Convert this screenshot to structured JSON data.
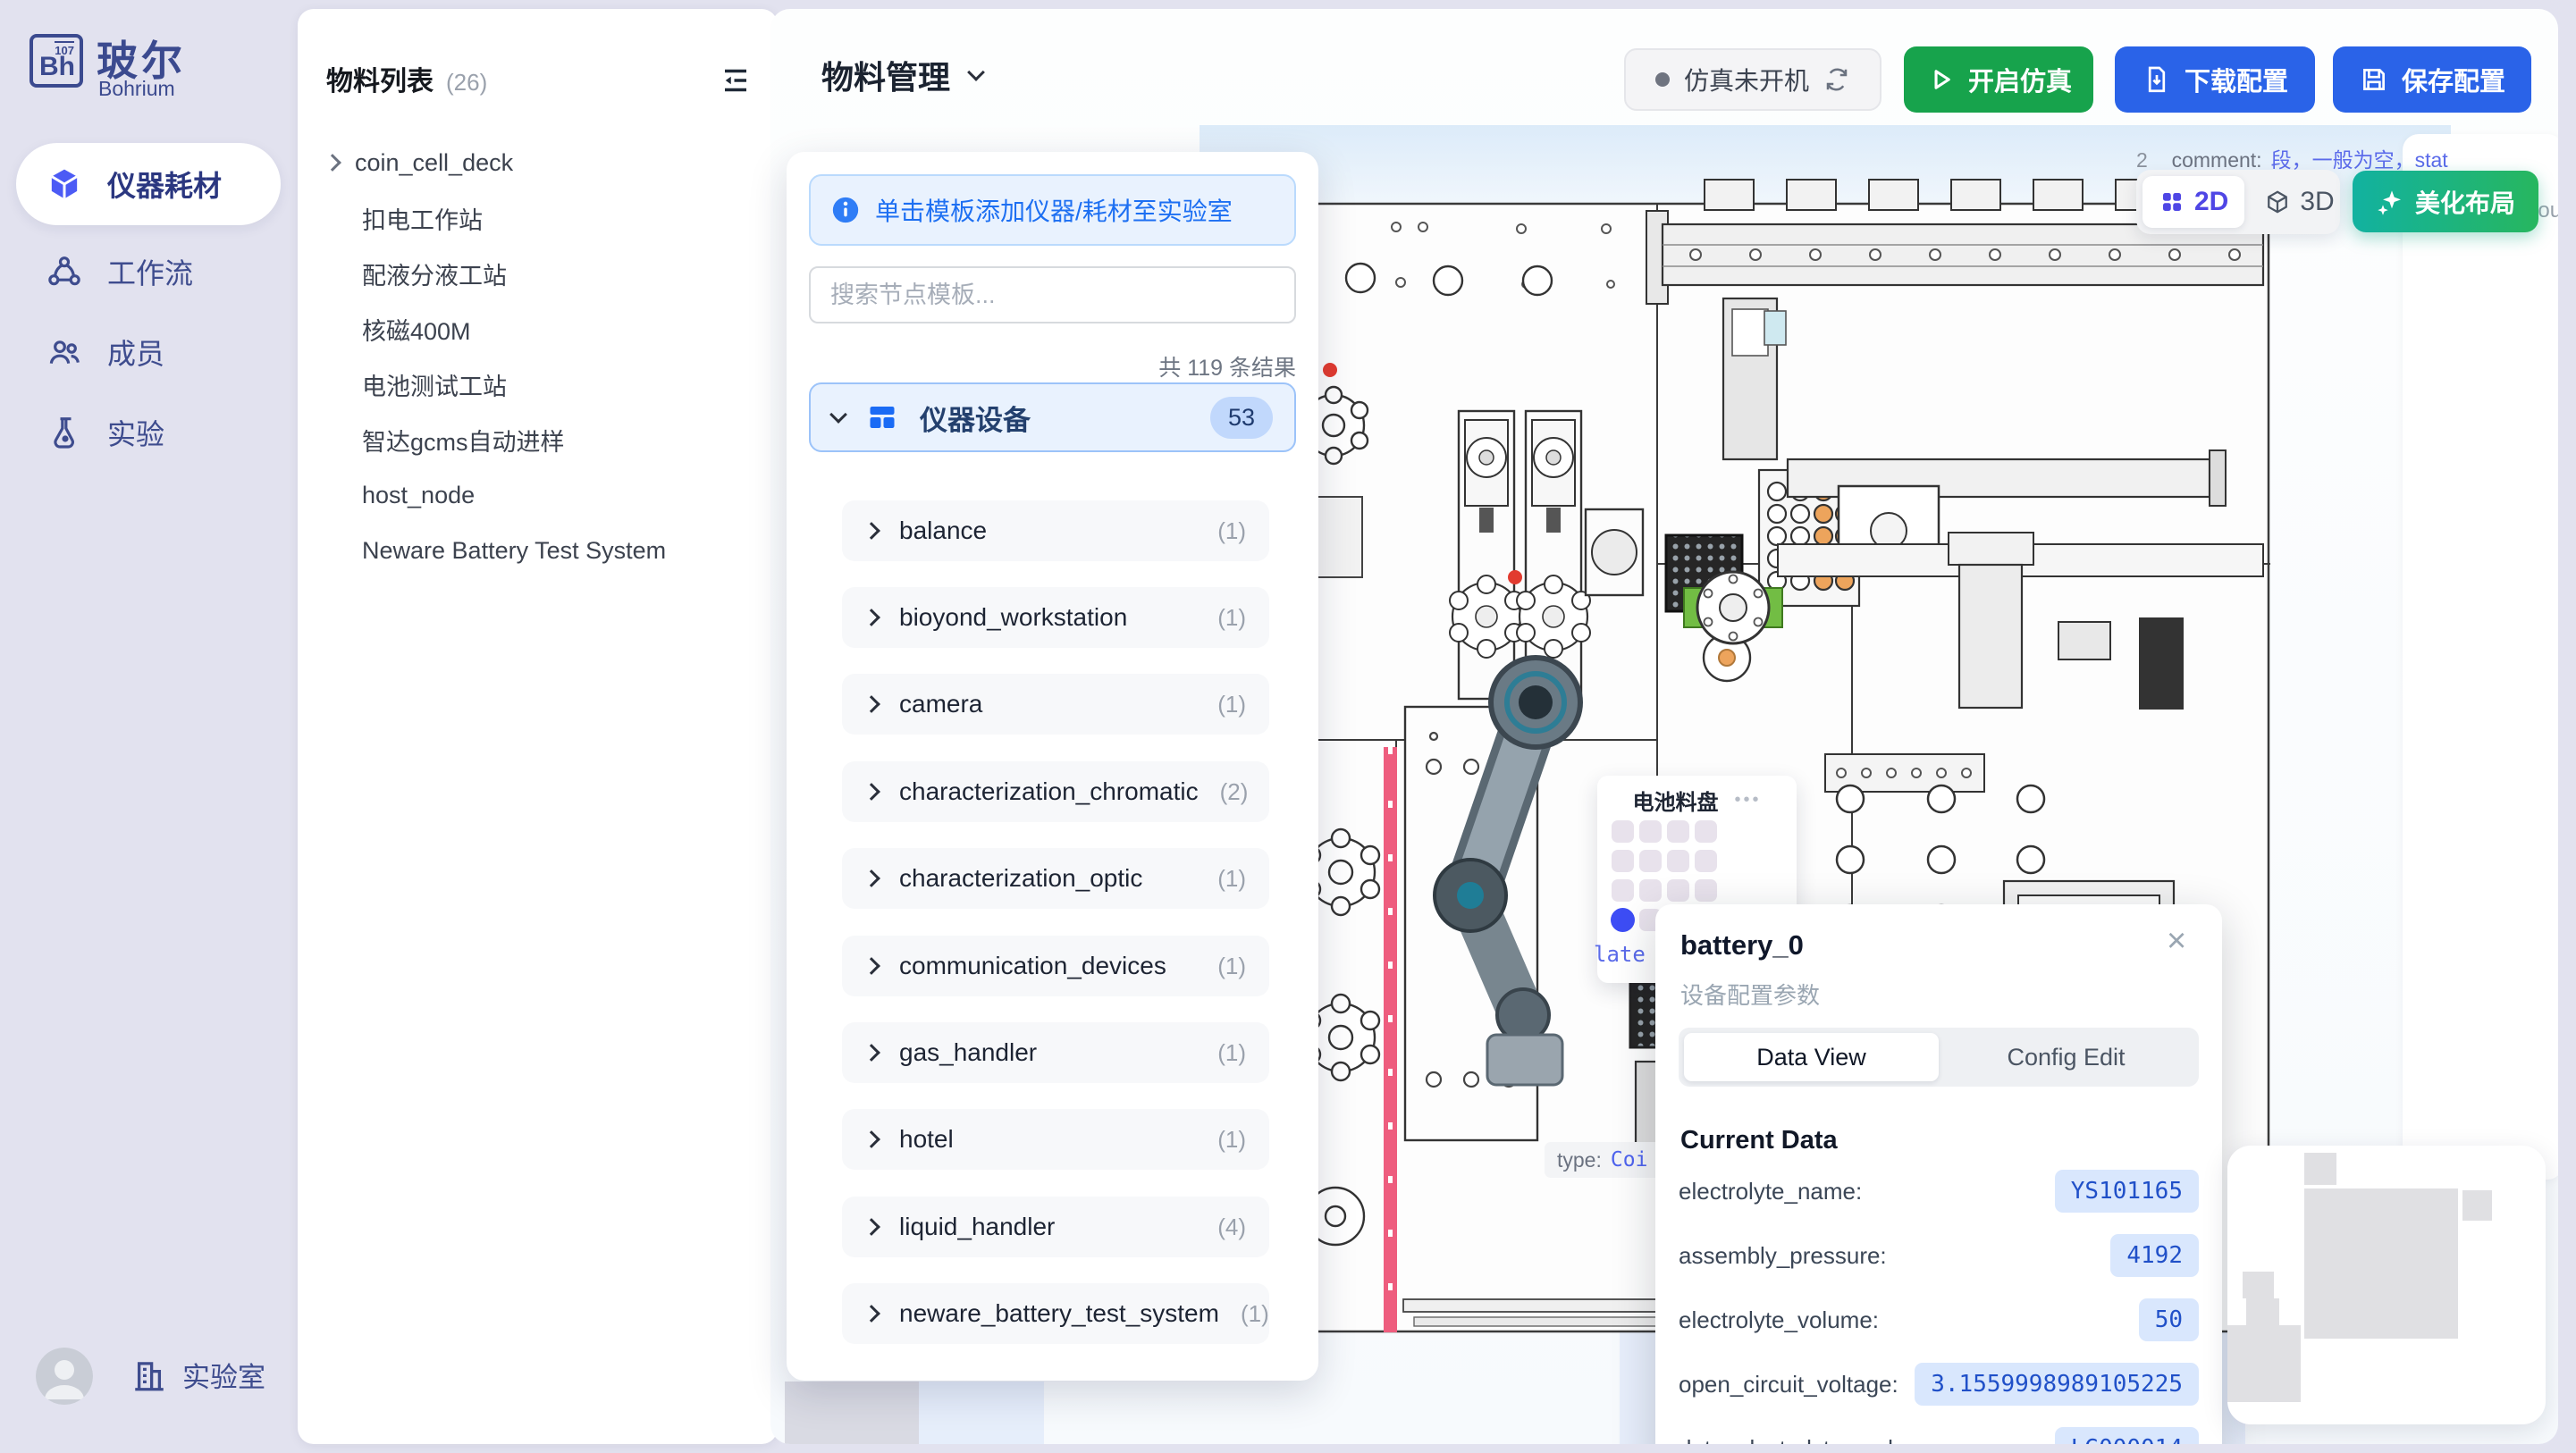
{
  "sidebar": {
    "logo": {
      "element": "Bh",
      "number": "107",
      "title": "玻尔",
      "subtitle": "Bohrium"
    },
    "items": [
      {
        "label": "仪器耗材",
        "icon": "cube-icon",
        "active": true
      },
      {
        "label": "工作流",
        "icon": "workflow-icon",
        "active": false
      },
      {
        "label": "成员",
        "icon": "members-icon",
        "active": false
      },
      {
        "label": "实验",
        "icon": "experiment-icon",
        "active": false
      }
    ],
    "footer": {
      "lab": "实验室"
    }
  },
  "materials": {
    "title": "物料列表",
    "count": "(26)",
    "items": [
      "coin_cell_deck",
      "扣电工作站",
      "配液分液工站",
      "核磁400M",
      "电池测试工站",
      "智达gcms自动进样",
      "host_node",
      "Neware Battery Test System"
    ]
  },
  "topbar": {
    "title": "物料管理",
    "status": "仿真未开机",
    "start": "开启仿真",
    "download": "下载配置",
    "save": "保存配置"
  },
  "templates": {
    "banner": "单击模板添加仪器/耗材至实验室",
    "search_placeholder": "搜索节点模板...",
    "results": "共 119 条结果",
    "category": {
      "label": "仪器设备",
      "badge": "53"
    },
    "items": [
      {
        "label": "balance",
        "count": "(1)"
      },
      {
        "label": "bioyond_workstation",
        "count": "(1)"
      },
      {
        "label": "camera",
        "count": "(1)"
      },
      {
        "label": "characterization_chromatic",
        "count": "(2)"
      },
      {
        "label": "characterization_optic",
        "count": "(1)"
      },
      {
        "label": "communication_devices",
        "count": "(1)"
      },
      {
        "label": "gas_handler",
        "count": "(1)"
      },
      {
        "label": "hotel",
        "count": "(1)"
      },
      {
        "label": "liquid_handler",
        "count": "(4)"
      },
      {
        "label": "neware_battery_test_system",
        "count": "(1)"
      }
    ]
  },
  "canvas": {
    "comment_prefix": "2",
    "comment_label": "_comment:",
    "comment_value": "段，一般为空，stat",
    "edge_fragment": "esou",
    "toggle": {
      "d2": "2D",
      "d3": "3D"
    },
    "beautify": "美化布局",
    "tray": {
      "title": "电池料盘",
      "menu": "•••",
      "plate_fragment": "late"
    },
    "type_label": "type:",
    "type_value": "Coi"
  },
  "popup": {
    "title": "battery_0",
    "subtitle": "设备配置参数",
    "close": "×",
    "tab_active": "Data View",
    "tab_inactive": "Config Edit",
    "section": "Current Data",
    "fields": [
      {
        "label": "electrolyte_name:",
        "value": "YS101165"
      },
      {
        "label": "assembly_pressure:",
        "value": "4192"
      },
      {
        "label": "electrolyte_volume:",
        "value": "50"
      },
      {
        "label": "open_circuit_voltage:",
        "value": "3.1559998989105225"
      },
      {
        "label": "data_electrolyte_code:",
        "value": "LG000014"
      }
    ]
  },
  "colors": {
    "accent_blue": "#2a63e8",
    "green": "#17a34c",
    "teal_green": "#12b2a0",
    "indigo": "#4f46e5",
    "value_blue": "#2050c8",
    "navy": "#3e4c8e"
  }
}
